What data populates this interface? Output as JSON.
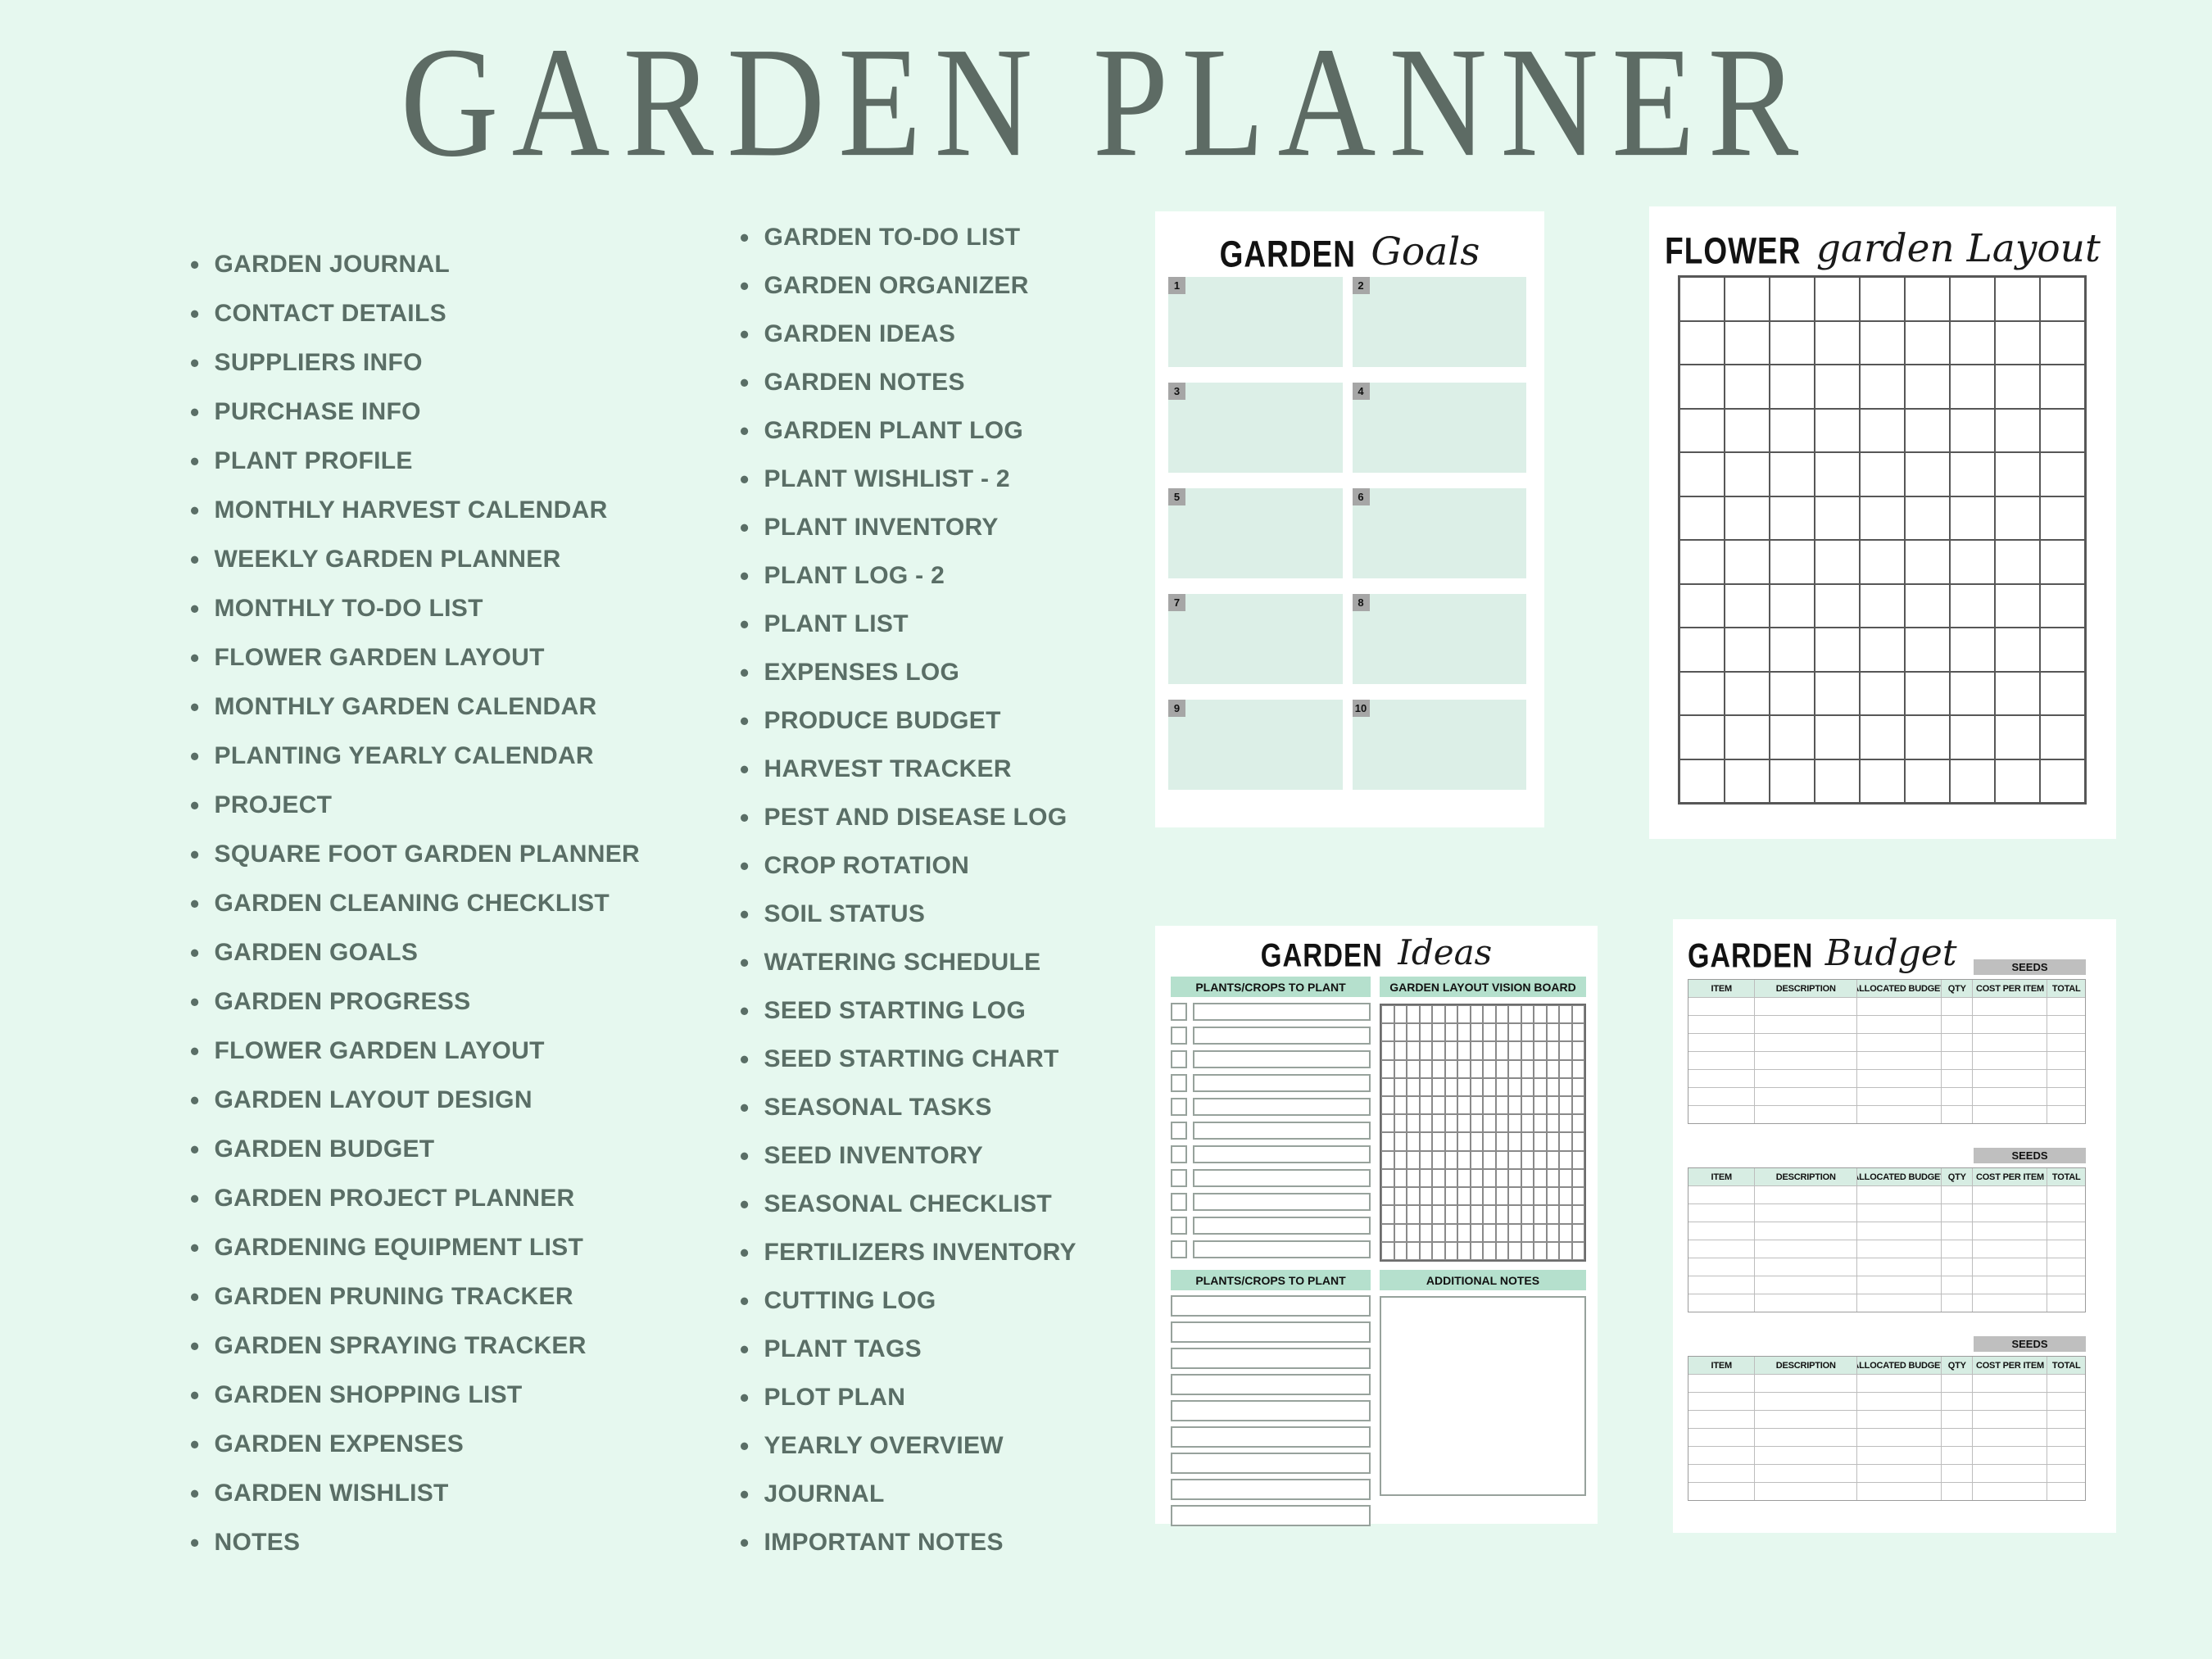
{
  "page": {
    "title": "GARDEN PLANNER",
    "bullet": "•"
  },
  "colors": {
    "background": "#e6f8ef",
    "heading_text": "#5d6b64",
    "list_text": "#5a6e66",
    "mint_box": "#dcefe7",
    "mint_bar": "#b5e0cd",
    "table_header_row": "#d7ede3",
    "seeds_bar": "#bfbfbf",
    "number_tab": "#a6a6a6",
    "card_background": "#ffffff"
  },
  "lists": {
    "column1": [
      "GARDEN JOURNAL",
      "CONTACT DETAILS",
      "SUPPLIERS INFO",
      "PURCHASE INFO",
      "PLANT PROFILE",
      "MONTHLY HARVEST CALENDAR",
      "WEEKLY GARDEN PLANNER",
      "MONTHLY TO-DO LIST",
      "FLOWER GARDEN LAYOUT",
      "MONTHLY GARDEN CALENDAR",
      "PLANTING YEARLY CALENDAR",
      "PROJECT",
      "SQUARE FOOT GARDEN PLANNER",
      "GARDEN CLEANING CHECKLIST",
      "GARDEN GOALS",
      "GARDEN PROGRESS",
      "FLOWER GARDEN LAYOUT",
      "GARDEN LAYOUT DESIGN",
      "GARDEN BUDGET",
      "GARDEN PROJECT PLANNER",
      "GARDENING EQUIPMENT LIST",
      "GARDEN PRUNING TRACKER",
      "GARDEN SPRAYING TRACKER",
      "GARDEN SHOPPING LIST",
      "GARDEN EXPENSES",
      "GARDEN WISHLIST",
      "NOTES"
    ],
    "column2": [
      "GARDEN TO-DO LIST",
      "GARDEN ORGANIZER",
      "GARDEN IDEAS",
      "GARDEN NOTES",
      "GARDEN PLANT LOG",
      "PLANT WISHLIST - 2",
      "PLANT INVENTORY",
      "PLANT LOG - 2",
      "PLANT LIST",
      "EXPENSES LOG",
      "PRODUCE BUDGET",
      "HARVEST TRACKER",
      "PEST AND DISEASE LOG",
      "CROP ROTATION",
      "SOIL STATUS",
      "WATERING SCHEDULE",
      "SEED STARTING LOG",
      "SEED STARTING CHART",
      "SEASONAL TASKS",
      "SEED INVENTORY",
      "SEASONAL CHECKLIST",
      "FERTILIZERS INVENTORY",
      "CUTTING LOG",
      "PLANT TAGS",
      "PLOT PLAN",
      "YEARLY OVERVIEW",
      "JOURNAL",
      "IMPORTANT NOTES"
    ]
  },
  "cards": {
    "goals": {
      "title_main": "GARDEN",
      "title_script": "Goals",
      "box_numbers": [
        "1",
        "2",
        "3",
        "4",
        "5",
        "6",
        "7",
        "8",
        "9",
        "10"
      ]
    },
    "flower": {
      "title_main": "FLOWER",
      "title_script": "garden Layout",
      "grid": {
        "cols": 9,
        "rows": 12
      }
    },
    "ideas": {
      "title_main": "GARDEN",
      "title_script": "Ideas",
      "top_left_header": "PLANTS/CROPS TO PLANT",
      "top_right_header": "GARDEN LAYOUT VISION BOARD",
      "bottom_left_header": "PLANTS/CROPS TO PLANT",
      "bottom_right_header": "ADDITIONAL NOTES",
      "checklist_rows": 11,
      "vision_grid": {
        "cols": 16,
        "rows": 14
      },
      "plain_rows": 9
    },
    "budget": {
      "title_main": "GARDEN",
      "title_script": "Budget",
      "section_label": "SEEDS",
      "columns": [
        "ITEM",
        "DESCRIPTION",
        "ALLOCATED BUDGET",
        "QTY",
        "COST PER ITEM",
        "TOTAL"
      ],
      "sections": 3,
      "rows_per_table": 7
    }
  }
}
